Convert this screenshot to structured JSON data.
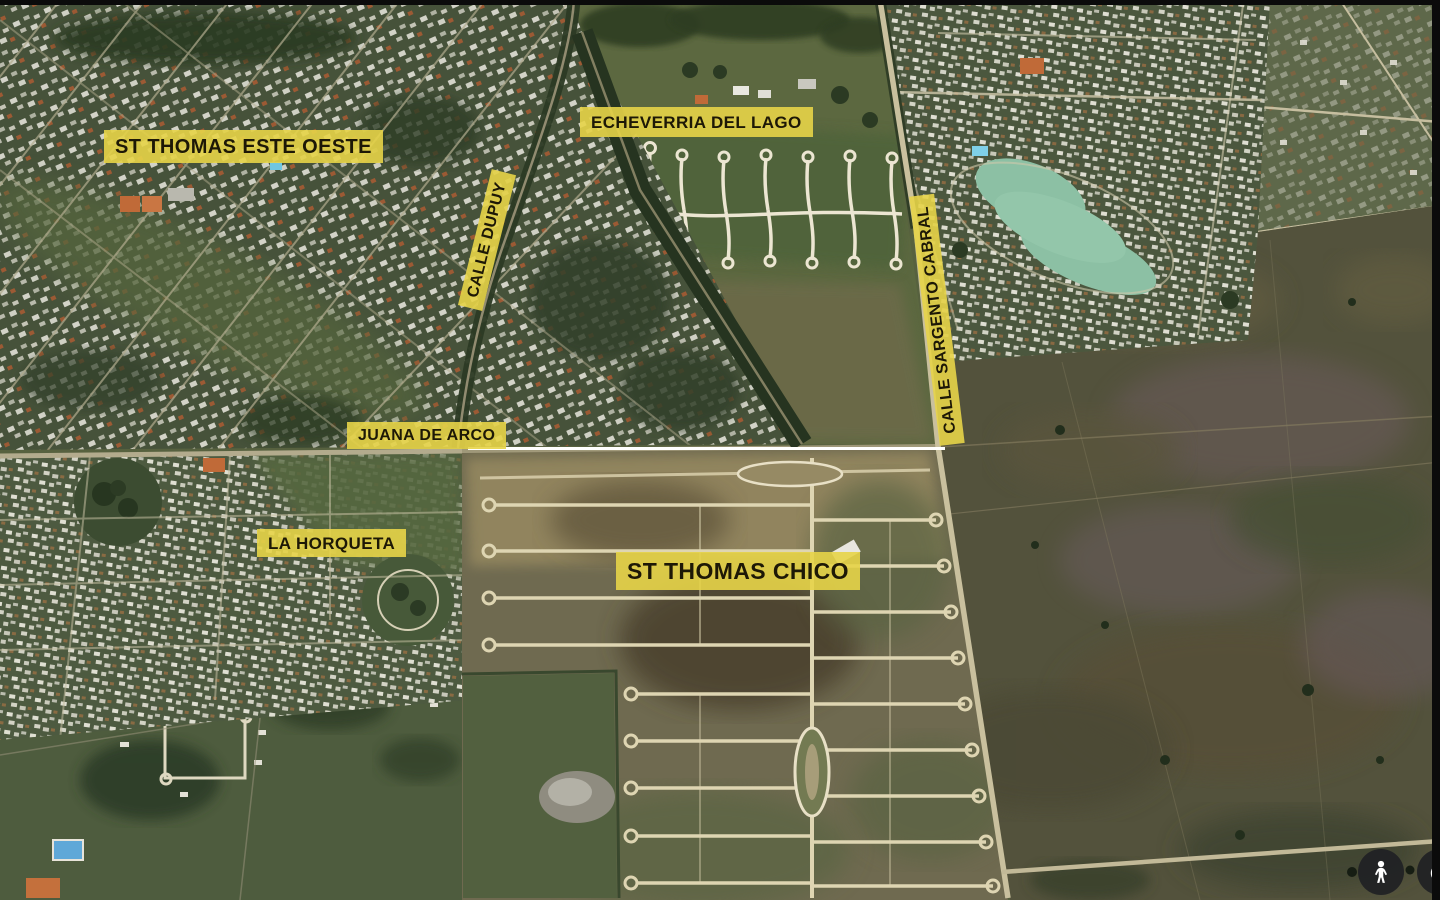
{
  "map": {
    "view": "satellite-aerial",
    "labels": {
      "st_thomas_este_oeste": "ST THOMAS ESTE OESTE",
      "echeverria_del_lago": "ECHEVERRIA DEL LAGO",
      "calle_dupuy": "CALLE DUPUY",
      "calle_sargento_cabral": "CALLE SARGENTO CABRAL",
      "juana_de_arco": "JUANA DE ARCO",
      "la_horqueta": "LA HORQUETA",
      "st_thomas_chico": "ST THOMAS CHICO"
    },
    "colors": {
      "label_background": "rgba(231,212,72,0.9)",
      "label_text": "#1d1806",
      "road_highlight": "#ffffff",
      "control_background": "rgba(31,33,36,0.92)",
      "control_glyph": "#ffffff",
      "lake": "#8cc0a4"
    },
    "controls": {
      "pegman": {
        "icon": "pegman-icon"
      },
      "compass": {
        "icon": "compass-icon"
      }
    }
  }
}
